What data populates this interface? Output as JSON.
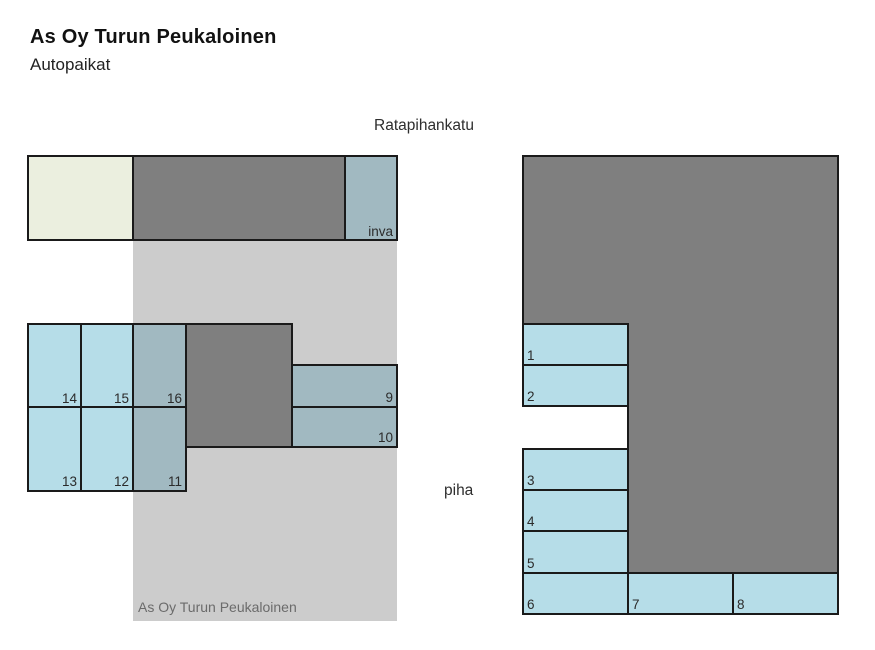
{
  "header": {
    "title": "As Oy Turun Peukaloinen",
    "subtitle": "Autopaikat"
  },
  "map": {
    "street_label": "Ratapihankatu",
    "yard_label": "piha",
    "building_label": "As Oy Turun Peukaloinen",
    "left": {
      "inva_label": "inva",
      "row_top": [
        "14",
        "15",
        "16"
      ],
      "row_bottom": [
        "13",
        "12",
        "11"
      ],
      "side_column": [
        "9",
        "10"
      ]
    },
    "right": {
      "wall_spaces": [
        "1",
        "2"
      ],
      "yard_spaces": [
        "3",
        "4",
        "5"
      ],
      "bottom_row": [
        "6",
        "7",
        "8"
      ]
    }
  },
  "colors": {
    "open_space": "#b6dde8",
    "covered_space": "#a1b9c1",
    "building": "#7f7f7f",
    "building_overlay": "#cccccc",
    "lawn": "#ebefdf",
    "outline": "#1a1a1a"
  }
}
